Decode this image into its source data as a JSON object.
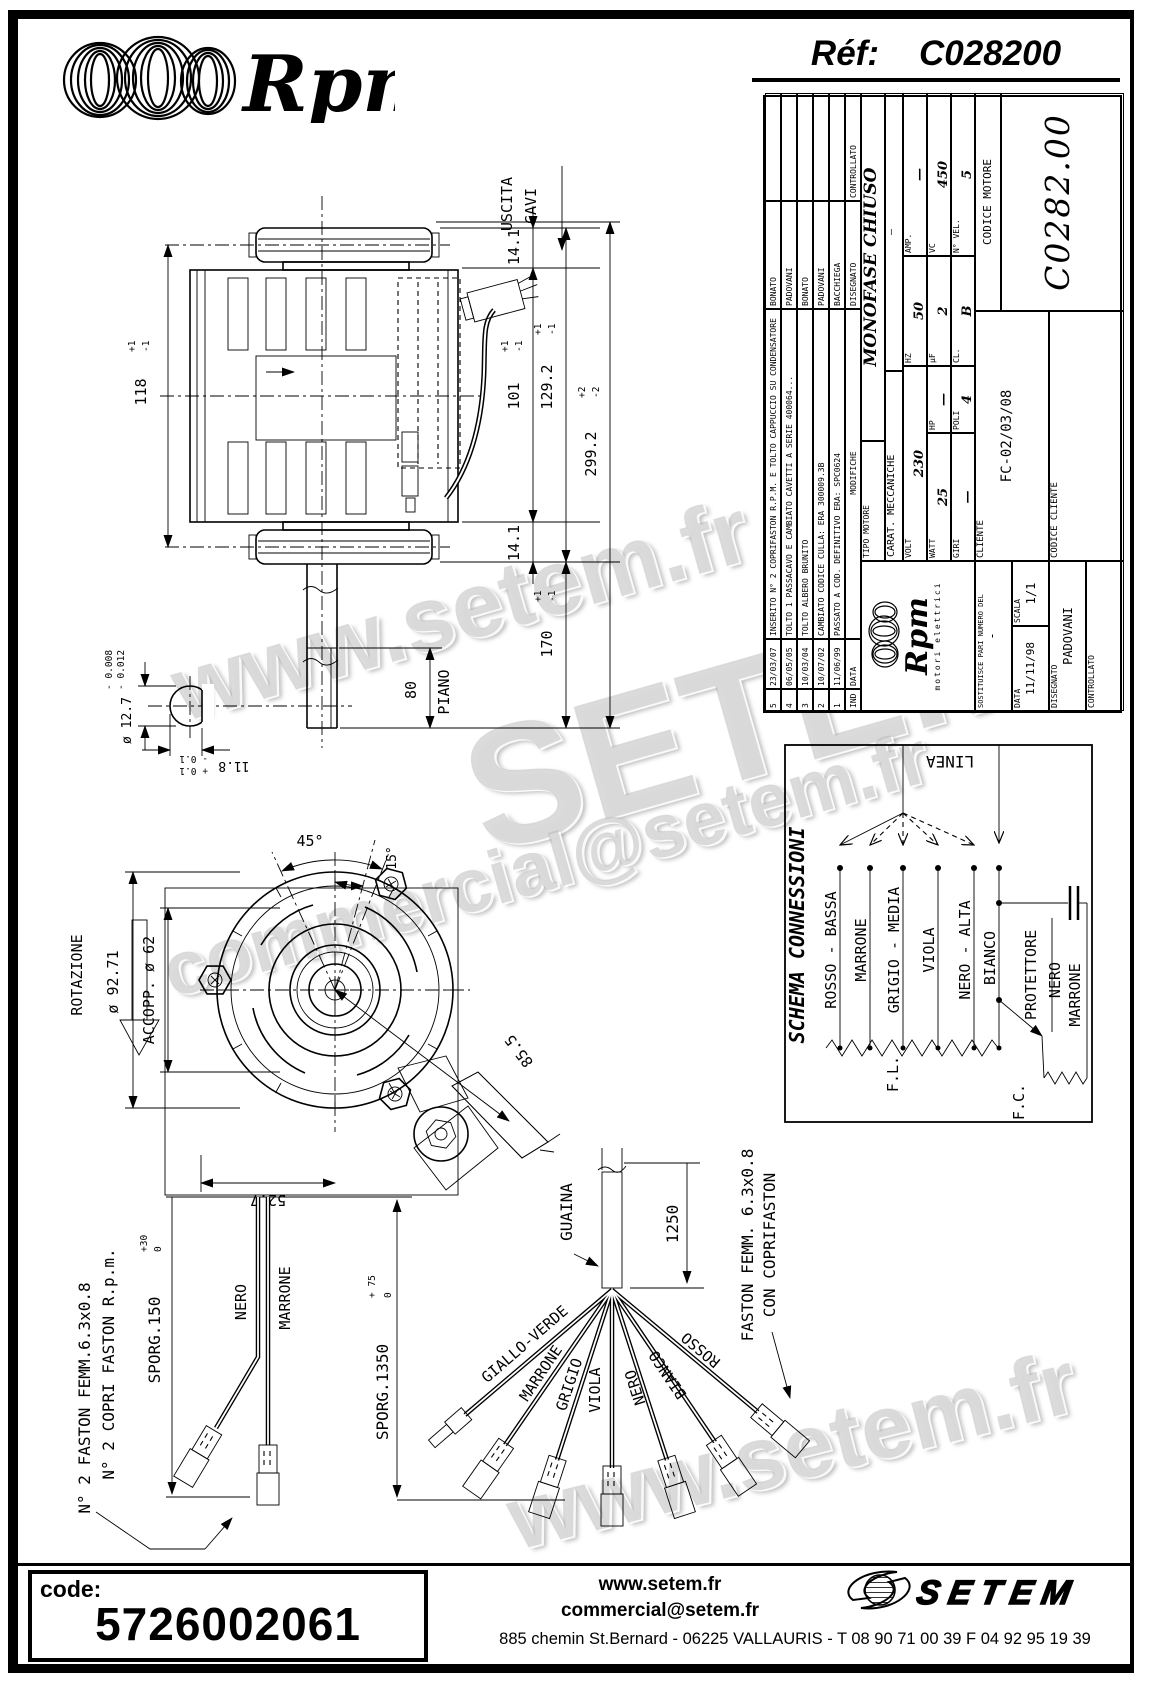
{
  "header": {
    "brand": "Rpm",
    "ref_label": "Réf:",
    "ref_value": "C028200"
  },
  "watermarks": {
    "w1": "www.setem.fr",
    "w2": "SETEM",
    "w3": "commercial@setem.fr",
    "w4": "www.setem.fr"
  },
  "title_block": {
    "revisions": [
      {
        "ind": "5",
        "date": "23/03/07",
        "desc": "INSERITO N° 2 COPRIFASTON R.P.M. E TOLTO CAPPUCCIO SU CONDENSATORE",
        "name": "BONATO"
      },
      {
        "ind": "4",
        "date": "06/05/05",
        "desc": "TOLTO 1 PASSACAVO E CAMBIATO CAVETTI A SERIE 400064...",
        "name": "PADOVANI"
      },
      {
        "ind": "3",
        "date": "10/03/04",
        "desc": "TOLTO ALBERO BRUNITO",
        "name": "BONATO"
      },
      {
        "ind": "2",
        "date": "10/07/02",
        "desc": "CAMBIATO CODICE CULLA: ERA 300009.3B",
        "name": "PADOVANI"
      },
      {
        "ind": "1",
        "date": "11/06/99",
        "desc": "PASSATO A COD. DEFINITIVO ERA: SPC0624",
        "name": "BACCHIEGA"
      }
    ],
    "rev_header": {
      "ind": "IND",
      "date": "DATA",
      "desc": "MODIFICHE",
      "disegnato": "DISEGNATO",
      "controllato": "CONTROLLATO"
    },
    "brand": {
      "name": "Rpm",
      "sub": "motori elettrici"
    },
    "tipo_label": "TIPO MOTORE",
    "tipo_value": "MONOFASE CHIUSO",
    "carat_label": "CARAT. MECCANICHE",
    "carat_value": "—",
    "specs": {
      "volt_l": "VOLT",
      "volt_v": "230",
      "hz_l": "HZ",
      "hz_v": "50",
      "amp_l": "AMP.",
      "amp_v": "—",
      "watt_l": "WATT",
      "watt_v": "25",
      "hp_l": "HP",
      "hp_v": "—",
      "uf_l": "μF",
      "uf_v": "2",
      "vc_l": "VC",
      "vc_v": "450",
      "giri_l": "GIRI",
      "giri_v": "—",
      "poli_l": "POLI",
      "poli_v": "4",
      "cl_l": "CL.",
      "cl_v": "B",
      "nvel_l": "N° VEL.",
      "nvel_v": "5"
    },
    "bottom": {
      "sostituisce_label": "SOSTITUISCE PARI NUMERO DEL",
      "sostituisce_value": "-",
      "data_label": "DATA",
      "data_value": "11/11/98",
      "scala_label": "SCALA",
      "scala_value": "1/1",
      "disegnato_label": "DISEGNATO",
      "disegnato_value": "PADOVANI",
      "controllato_label": "CONTROLLATO",
      "controllato_value": "",
      "cliente_label": "CLIENTE",
      "cliente_value": "FC-02/03/08",
      "codice_cliente_label": "CODICE CLIENTE",
      "codice_cliente_value": "",
      "codice_motore_label": "CODICE MOTORE",
      "codice_motore_value": "C0282.00"
    }
  },
  "side": {
    "uscita1": "USCITA",
    "uscita2": "CAVI",
    "d118": "118",
    "d118p": "+1",
    "d118m": "-1",
    "d141t": "14.1",
    "d141b": "14.1",
    "d101": "101",
    "d101p": "+1",
    "d101m": "-1",
    "d1292": "129.2",
    "d1292p": "+1",
    "d1292m": "-1",
    "d2992": "299.2",
    "d2992p": "+2",
    "d2992m": "-2",
    "d170": "170",
    "d170p": "+1",
    "d170m": "-1",
    "d80": "80",
    "piano": "PIANO",
    "d127": "ø 12.7",
    "d127a": "- 0.008",
    "d127b": "- 0.012",
    "d118s": "11.8",
    "d118sp": "+ 0.1",
    "d118sm": "- 0.1"
  },
  "front": {
    "rotazione": "ROTAZIONE",
    "d9271": "ø 92.71",
    "accopp": "ACCOPP. ø 62",
    "a45": "45°",
    "a15": "15°",
    "d855": "85.5",
    "d527": "52.7"
  },
  "schema": {
    "title": "SCHEMA CONNESSIONI",
    "linea": "LINEA",
    "w1": "ROSSO - BASSA",
    "w2": "MARRONE",
    "w3": "GRIGIO - MEDIA",
    "w4": "VIOLA",
    "w5": "NERO - ALTA",
    "w6": "BIANCO",
    "w7": "PROTETTORE",
    "w8": "NERO",
    "w9": "MARRONE",
    "fl": "F.L.",
    "fc": "F.C."
  },
  "cable_left": {
    "note1": "N° 2 FASTON FEMM.6.3x0.8",
    "note2": "N° 2 COPRI FASTON R.p.m.",
    "sporg": "SPORG.150",
    "sporgp": "+30",
    "sporgm": "0",
    "nero": "NERO",
    "marrone": "MARRONE"
  },
  "bundle": {
    "guaina": "GUAINA",
    "d1250": "1250",
    "sporg": "SPORG.1350",
    "sporgp": "+ 75",
    "sporgm": "0",
    "w1": "GIALLO-VERDE",
    "w2": "MARRONE",
    "w3": "GRIGIO",
    "w4": "VIOLA",
    "w5": "NERO",
    "w6": "BIANCO",
    "w7": "ROSSO",
    "note1": "FASTON FEMM. 6.3x0.8",
    "note2": "CON COPRIFASTON"
  },
  "footer": {
    "code_label": "code:",
    "code_value": "5726002061",
    "web": "www.setem.fr",
    "email": "commercial@setem.fr",
    "address": "885 chemin St.Bernard  -  06225 VALLAURIS  -  T 08 90 71 00 39   F 04 92 95 19 39",
    "logo": "SETEM"
  }
}
